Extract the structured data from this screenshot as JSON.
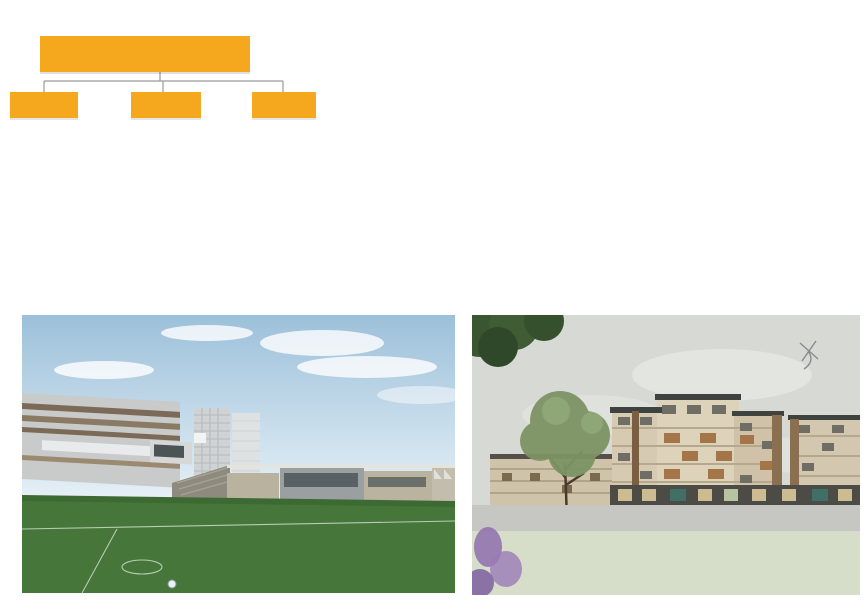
{
  "diagram": {
    "title_main": "雄安标准",
    "title_suffix": "配套构成",
    "question_mark": "?",
    "branches": [
      {
        "tag": "“标配”",
        "heading": "国家标准",
        "sub": "（适度提高）",
        "notes": [
          "严格管控",
          "标准预留"
        ]
      },
      {
        "tag": "“增配”",
        "heading": "创新配套",
        "sub": "（趋势+实证研究）",
        "notes": [
          "弹性控制",
          "灵活预留"
        ]
      },
      {
        "tag": "“选配”",
        "heading": "特色配套",
        "sub": "（社区分类+性格",
        "notes": [
          "政策引导",
          "市场运营"
        ]
      }
    ],
    "colors": {
      "accent_yellow": "#F5A71D",
      "text": "#141414",
      "connector": "#9a9a9a"
    }
  },
  "city_map": {
    "colors": {
      "block_gray": "#ababab",
      "light_gray": "#dcdcdc",
      "red": "#e8190f",
      "orange": "#f29100",
      "green": "#7de883",
      "box_yellow": "#f2b12e",
      "dash_black": "#111111"
    },
    "center_strip": {
      "x": 234,
      "y": 2,
      "w": 38,
      "h": 239
    },
    "highlights": [
      {
        "id": "A",
        "style": "yellow",
        "x": 33,
        "y": 39,
        "w": 37,
        "h": 47
      },
      {
        "id": "B",
        "style": "yellow",
        "x": 149,
        "y": 49,
        "w": 38,
        "h": 48
      },
      {
        "id": "C",
        "style": "yellow",
        "x": 325,
        "y": 50,
        "w": 37,
        "h": 46
      },
      {
        "id": "D",
        "style": "dashed",
        "x": 405,
        "y": 49,
        "w": 25,
        "h": 64
      },
      {
        "id": "E",
        "style": "yellow",
        "x": 69,
        "y": 142,
        "w": 26,
        "h": 58
      },
      {
        "id": "F",
        "style": "dashed",
        "x": 119,
        "y": 122,
        "w": 31,
        "h": 106
      },
      {
        "id": "G",
        "style": "yellow",
        "x": 150,
        "y": 125,
        "w": 25,
        "h": 45
      },
      {
        "id": "H",
        "style": "yellow",
        "x": 290,
        "y": 179,
        "w": 36,
        "h": 26
      },
      {
        "id": "I",
        "style": "dashed",
        "x": 327,
        "y": 120,
        "w": 56,
        "h": 108
      },
      {
        "id": "J",
        "style": "yellow",
        "x": 430,
        "y": 140,
        "w": 41,
        "h": 50
      }
    ]
  },
  "land_strip": {
    "colors": {
      "urban_bg": "#a4d768",
      "block_orange": "#ee9a4a",
      "block_yellow": "#f0d050",
      "block_green": "#8cc85e",
      "park": "#8ccb5e",
      "tree": "#337a35",
      "river": "#58a8de",
      "red_divider": "#cc1c1c"
    },
    "node_x": 88,
    "segments": [
      {
        "type": "park-river",
        "x": 0,
        "w": 104
      },
      {
        "type": "divider",
        "x": 104,
        "w": 0
      },
      {
        "type": "urban",
        "x": 107,
        "w": 120
      },
      {
        "type": "stream",
        "x": 227,
        "w": 21
      },
      {
        "type": "urban",
        "x": 248,
        "w": 95
      },
      {
        "type": "divider",
        "x": 344,
        "w": 0
      },
      {
        "type": "urban",
        "x": 347,
        "w": 139
      },
      {
        "type": "red",
        "x": 488,
        "w": 0
      },
      {
        "type": "urban",
        "x": 495,
        "w": 49
      },
      {
        "type": "park-river",
        "x": 544,
        "w": 62
      },
      {
        "type": "divider",
        "x": 607,
        "w": 0
      },
      {
        "type": "urban",
        "x": 610,
        "w": 76
      },
      {
        "type": "red",
        "x": 688,
        "w": 0
      },
      {
        "type": "urban",
        "x": 695,
        "w": 60
      },
      {
        "type": "divider",
        "x": 756,
        "w": 0
      },
      {
        "type": "park-lake",
        "x": 759,
        "w": 83
      }
    ]
  },
  "renders": {
    "sport_park": {
      "watermark": "SPORT P"
    },
    "residential": {}
  }
}
